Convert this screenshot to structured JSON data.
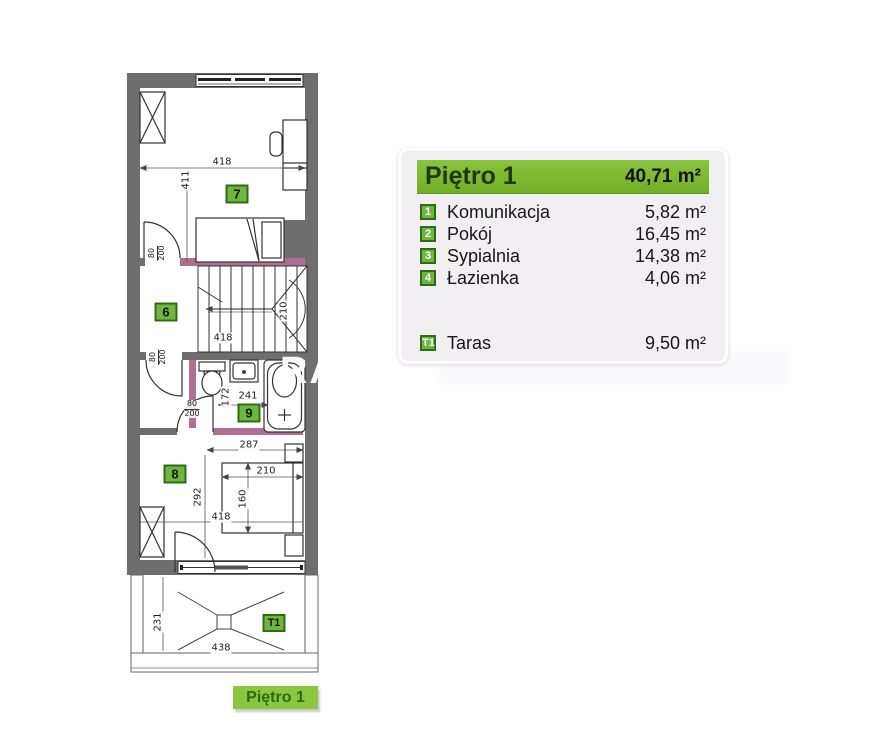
{
  "legend": {
    "title": "Piętro 1",
    "total_area": "40,71 m²",
    "rooms": [
      {
        "num": "1",
        "name": "Komunikacja",
        "area": "5,82 m²"
      },
      {
        "num": "2",
        "name": "Pokój",
        "area": "16,45 m²"
      },
      {
        "num": "3",
        "name": "Sypialnia",
        "area": "14,38 m²"
      },
      {
        "num": "4",
        "name": "Łazienka",
        "area": "4,06 m²"
      }
    ],
    "extra": {
      "num": "T1",
      "name": "Taras",
      "area": "9,50 m²"
    }
  },
  "floor_label": "Piętro 1",
  "watermark": {
    "text": "RA"
  },
  "plan": {
    "markers": [
      {
        "label": "7",
        "x": 237,
        "y": 194,
        "small": false
      },
      {
        "label": "6",
        "x": 166,
        "y": 312,
        "small": false
      },
      {
        "label": "9",
        "x": 249,
        "y": 413,
        "small": false
      },
      {
        "label": "8",
        "x": 175,
        "y": 474,
        "small": false
      },
      {
        "label": "T1",
        "x": 274,
        "y": 623,
        "small": true
      }
    ],
    "dimensions": [
      {
        "text": "418",
        "x": 222,
        "y": 162,
        "rot": false
      },
      {
        "text": "411",
        "x": 186,
        "y": 180,
        "rot": true
      },
      {
        "text": "418",
        "x": 223,
        "y": 338,
        "rot": false
      },
      {
        "text": "210",
        "x": 284,
        "y": 311,
        "rot": true
      },
      {
        "text": "172",
        "x": 226,
        "y": 397,
        "rot": true
      },
      {
        "text": "241",
        "x": 248,
        "y": 396,
        "rot": false
      },
      {
        "text": "287",
        "x": 249,
        "y": 445,
        "rot": false
      },
      {
        "text": "292",
        "x": 198,
        "y": 497,
        "rot": true
      },
      {
        "text": "210",
        "x": 266,
        "y": 471,
        "rot": false
      },
      {
        "text": "160",
        "x": 243,
        "y": 499,
        "rot": true
      },
      {
        "text": "418",
        "x": 221,
        "y": 517,
        "rot": false
      },
      {
        "text": "231",
        "x": 158,
        "y": 622,
        "rot": true
      },
      {
        "text": "438",
        "x": 221,
        "y": 648,
        "rot": false
      }
    ],
    "door_labels": [
      {
        "top": "80",
        "bottom": "200",
        "x": 157,
        "y": 253,
        "rot": true
      },
      {
        "top": "80",
        "bottom": "200",
        "x": 158,
        "y": 357,
        "rot": true
      },
      {
        "top": "80",
        "bottom": "200",
        "x": 192,
        "y": 409,
        "rot": false
      }
    ]
  },
  "colors": {
    "wall": "#6e6e6e",
    "accent_pink": "#ad6f92",
    "marker_green": "#6fb53e",
    "marker_border": "#2e6b15",
    "legend_green": "#7cb82f",
    "banner_green": "#8cc63e"
  }
}
